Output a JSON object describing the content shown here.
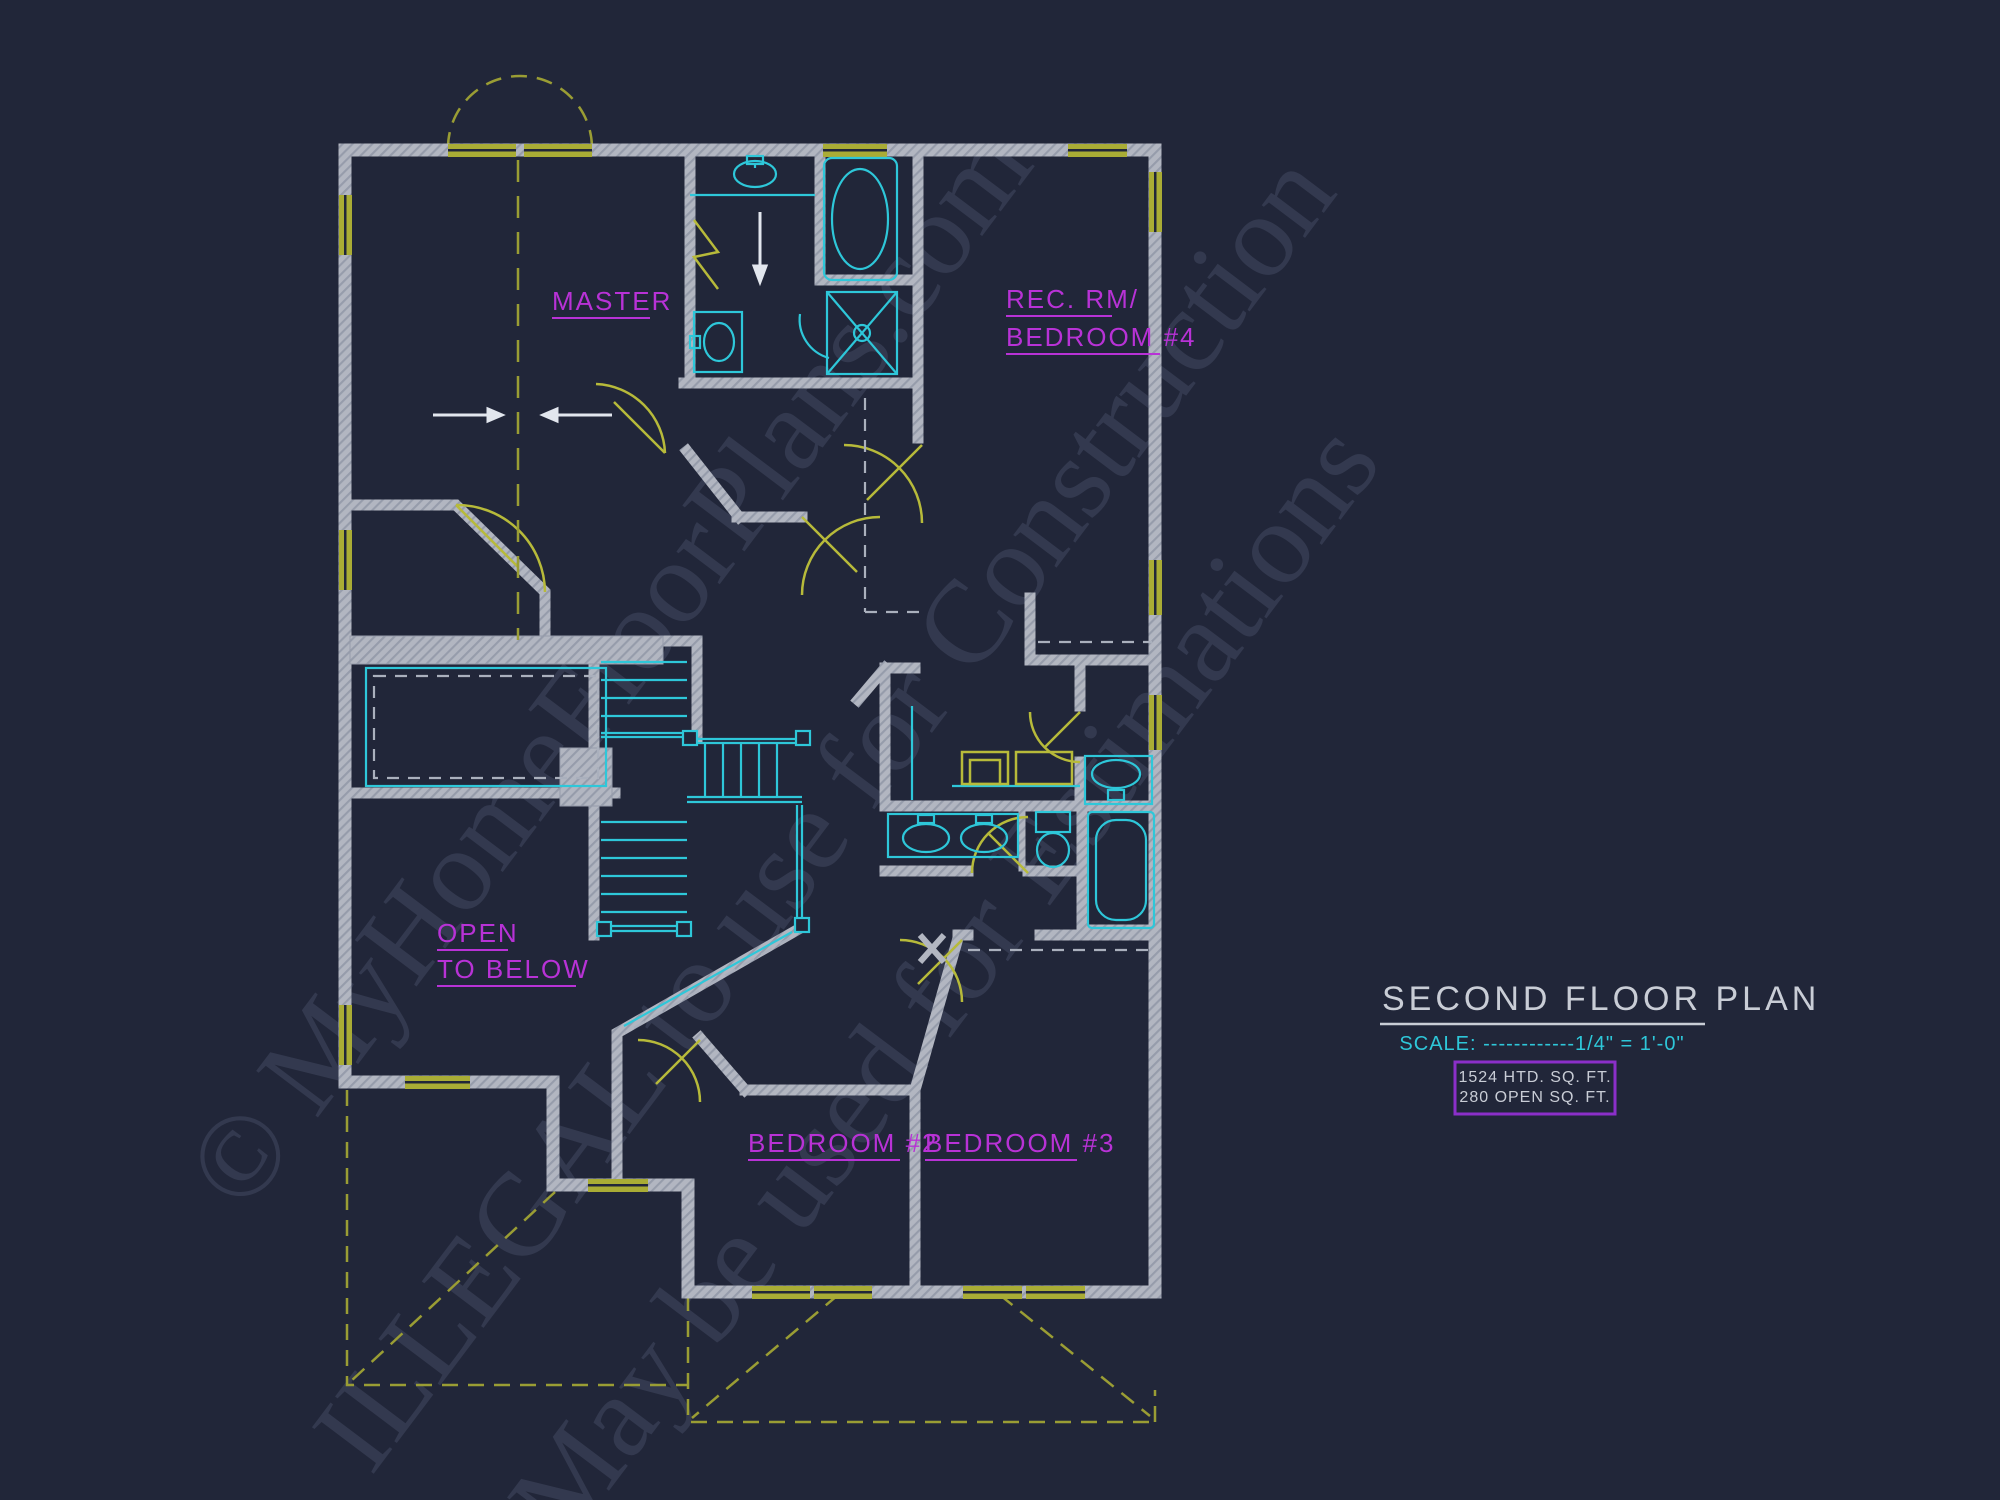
{
  "page": {
    "background": "#212639"
  },
  "watermark": {
    "line1": "© MyHomeFloorPlans.com",
    "line2": "ILLEGAL to use for Construction",
    "line3": "May be used for Estimations"
  },
  "rooms": {
    "master": "MASTER",
    "rec_rm_line1": "REC. RM/",
    "rec_rm_line2": "BEDROOM #4",
    "open_below_line1": "OPEN",
    "open_below_line2": "TO BELOW",
    "bedroom2": "BEDROOM #2",
    "bedroom3": "BEDROOM #3"
  },
  "title_block": {
    "title": "SECOND FLOOR PLAN",
    "scale_text": "SCALE: ------------1/4\" = 1'-0\"",
    "area_heated": "1524 HTD. SQ. FT.",
    "area_open": "280 OPEN SQ. FT."
  },
  "colors": {
    "background": "#212639",
    "wall_gray": "#b2b6c1",
    "wall_hatch": "#969cab",
    "fixture_cyan": "#2ec7d9",
    "window_olive": "#a9ac35",
    "label_magenta": "#b832d6",
    "title_gray": "#c9cdd6",
    "area_box_purple": "#8b2fc9",
    "arrow_white": "#e2e6ee"
  }
}
